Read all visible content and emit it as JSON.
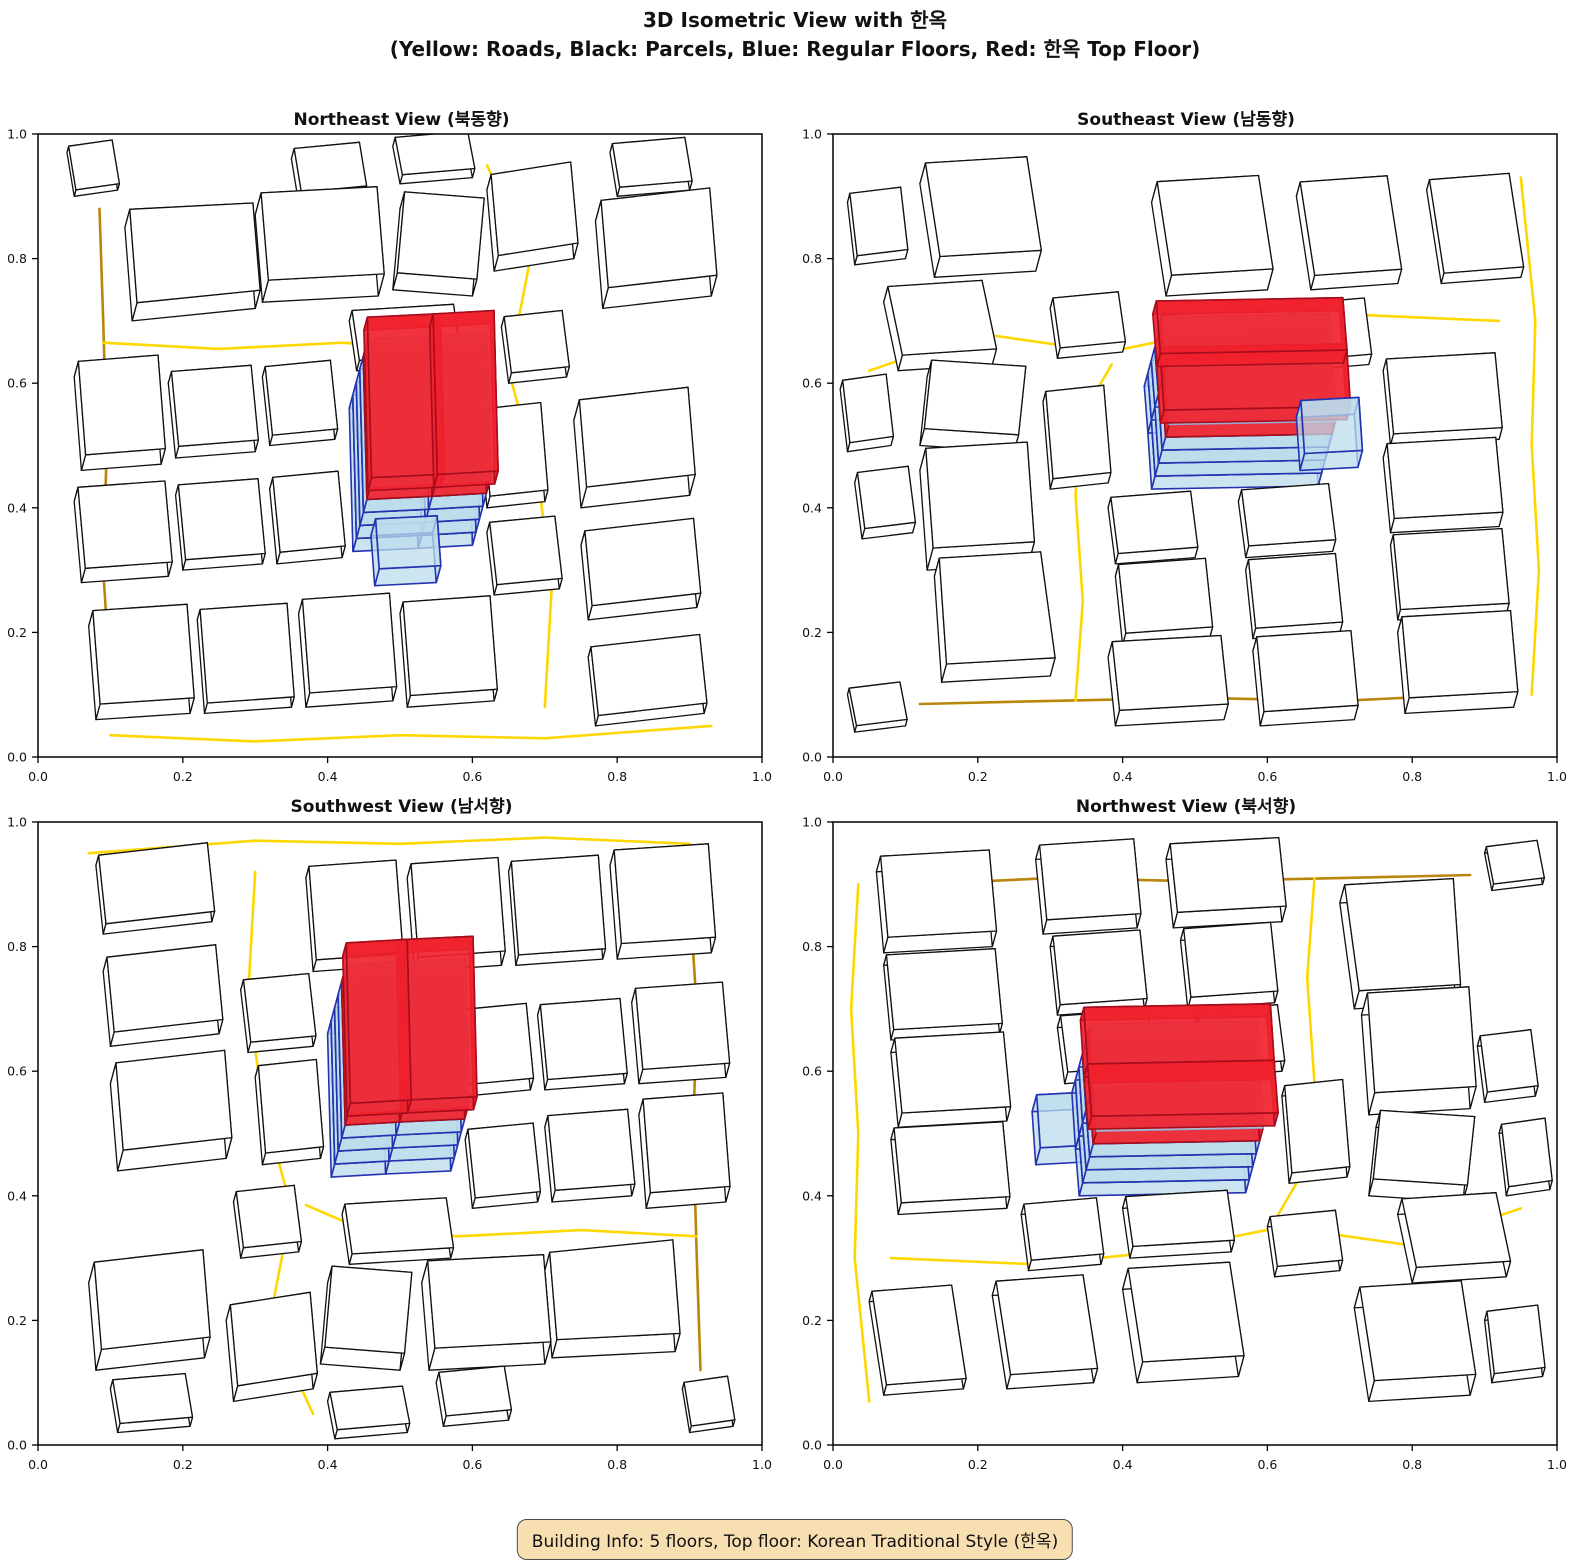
{
  "figure": {
    "title_line1": "3D Isometric View with 한옥",
    "title_line2": "(Yellow: Roads, Black: Parcels, Blue: Regular Floors, Red: 한옥 Top Floor)"
  },
  "panels": [
    {
      "title": "Northeast View (북동향)",
      "rotation_deg": 0
    },
    {
      "title": "Southeast View (남동향)",
      "rotation_deg": 90
    },
    {
      "title": "Southwest View (남서향)",
      "rotation_deg": 180
    },
    {
      "title": "Northwest View (북서향)",
      "rotation_deg": 270
    }
  ],
  "axes": {
    "ticks": [
      "0.0",
      "0.2",
      "0.4",
      "0.6",
      "0.8",
      "1.0"
    ],
    "range": [
      0,
      1
    ]
  },
  "legend": {
    "yellow": "Roads",
    "black": "Parcels",
    "blue": "Regular Floors",
    "red": "한옥 Top Floor"
  },
  "building_info": {
    "floors": 5,
    "top_floor_style": "Korean Traditional Style (한옥)"
  },
  "caption": {
    "text": "Building Info: 5 floors, Top floor: Korean Traditional Style (한옥)"
  },
  "colors": {
    "background": "#ffffff",
    "frame": "#000000",
    "road_gold": "#FFD700",
    "road_dark": "#B8860B",
    "parcel_fill": "#FFFFFF",
    "parcel_edge": "#111111",
    "floor_fill": "#BCDCEC",
    "floor_edge": "#2433B0",
    "floor_edge_light": "#8FA8D8",
    "hanok_fill": "#F0222E",
    "hanok_edge": "#A50D1C",
    "caption_bg": "#F7DFB2",
    "caption_border": "#4D4D4D"
  },
  "scene": {
    "projection": {
      "plot_w": 724,
      "plot_h": 623,
      "height_dx": 3.5,
      "height_dy": -13
    },
    "roads": [
      {
        "pts": [
          [
            0.085,
            0.88
          ],
          [
            0.09,
            0.7
          ],
          [
            0.095,
            0.5
          ],
          [
            0.09,
            0.3
          ],
          [
            0.1,
            0.12
          ]
        ],
        "tone": "dark"
      },
      {
        "pts": [
          [
            0.09,
            0.665
          ],
          [
            0.25,
            0.655
          ],
          [
            0.42,
            0.665
          ],
          [
            0.55,
            0.655
          ],
          [
            0.63,
            0.615
          ]
        ],
        "tone": "gold"
      },
      {
        "pts": [
          [
            0.62,
            0.95
          ],
          [
            0.68,
            0.8
          ],
          [
            0.65,
            0.62
          ],
          [
            0.69,
            0.45
          ],
          [
            0.71,
            0.28
          ],
          [
            0.7,
            0.08
          ]
        ],
        "tone": "gold"
      },
      {
        "pts": [
          [
            0.1,
            0.035
          ],
          [
            0.3,
            0.025
          ],
          [
            0.5,
            0.035
          ],
          [
            0.7,
            0.03
          ],
          [
            0.93,
            0.05
          ]
        ],
        "tone": "gold"
      }
    ],
    "buildings": [
      {
        "pts": [
          [
            0.13,
            0.7
          ],
          [
            0.3,
            0.72
          ],
          [
            0.29,
            0.86
          ],
          [
            0.12,
            0.85
          ]
        ],
        "h": 1.4
      },
      {
        "pts": [
          [
            0.31,
            0.73
          ],
          [
            0.47,
            0.74
          ],
          [
            0.46,
            0.88
          ],
          [
            0.3,
            0.87
          ]
        ],
        "h": 1.7
      },
      {
        "pts": [
          [
            0.36,
            0.89
          ],
          [
            0.45,
            0.9
          ],
          [
            0.44,
            0.97
          ],
          [
            0.35,
            0.96
          ]
        ],
        "h": 0.8
      },
      {
        "pts": [
          [
            0.49,
            0.75
          ],
          [
            0.6,
            0.74
          ],
          [
            0.61,
            0.87
          ],
          [
            0.5,
            0.88
          ]
        ],
        "h": 1.3
      },
      {
        "pts": [
          [
            0.63,
            0.78
          ],
          [
            0.74,
            0.8
          ],
          [
            0.73,
            0.93
          ],
          [
            0.62,
            0.91
          ]
        ],
        "h": 1.2
      },
      {
        "pts": [
          [
            0.78,
            0.72
          ],
          [
            0.93,
            0.74
          ],
          [
            0.92,
            0.88
          ],
          [
            0.77,
            0.86
          ]
        ],
        "h": 1.6
      },
      {
        "pts": [
          [
            0.8,
            0.9
          ],
          [
            0.9,
            0.91
          ],
          [
            0.89,
            0.98
          ],
          [
            0.79,
            0.97
          ]
        ],
        "h": 0.7
      },
      {
        "pts": [
          [
            0.06,
            0.46
          ],
          [
            0.17,
            0.47
          ],
          [
            0.16,
            0.62
          ],
          [
            0.05,
            0.61
          ]
        ],
        "h": 1.2
      },
      {
        "pts": [
          [
            0.19,
            0.48
          ],
          [
            0.3,
            0.49
          ],
          [
            0.29,
            0.61
          ],
          [
            0.18,
            0.6
          ]
        ],
        "h": 0.9
      },
      {
        "pts": [
          [
            0.32,
            0.5
          ],
          [
            0.41,
            0.51
          ],
          [
            0.4,
            0.62
          ],
          [
            0.31,
            0.61
          ]
        ],
        "h": 0.8
      },
      {
        "pts": [
          [
            0.06,
            0.28
          ],
          [
            0.18,
            0.29
          ],
          [
            0.17,
            0.42
          ],
          [
            0.05,
            0.41
          ]
        ],
        "h": 1.1
      },
      {
        "pts": [
          [
            0.2,
            0.3
          ],
          [
            0.31,
            0.31
          ],
          [
            0.3,
            0.43
          ],
          [
            0.19,
            0.42
          ]
        ],
        "h": 0.8
      },
      {
        "pts": [
          [
            0.33,
            0.31
          ],
          [
            0.42,
            0.32
          ],
          [
            0.41,
            0.44
          ],
          [
            0.32,
            0.43
          ]
        ],
        "h": 0.9
      },
      {
        "pts": [
          [
            0.08,
            0.06
          ],
          [
            0.21,
            0.07
          ],
          [
            0.2,
            0.22
          ],
          [
            0.07,
            0.21
          ]
        ],
        "h": 1.2
      },
      {
        "pts": [
          [
            0.23,
            0.07
          ],
          [
            0.35,
            0.08
          ],
          [
            0.34,
            0.23
          ],
          [
            0.22,
            0.22
          ]
        ],
        "h": 0.8
      },
      {
        "pts": [
          [
            0.37,
            0.08
          ],
          [
            0.49,
            0.09
          ],
          [
            0.48,
            0.24
          ],
          [
            0.36,
            0.23
          ]
        ],
        "h": 1.1
      },
      {
        "pts": [
          [
            0.51,
            0.08
          ],
          [
            0.63,
            0.09
          ],
          [
            0.62,
            0.24
          ],
          [
            0.5,
            0.23
          ]
        ],
        "h": 0.9
      },
      {
        "pts": [
          [
            0.75,
            0.4
          ],
          [
            0.9,
            0.42
          ],
          [
            0.89,
            0.56
          ],
          [
            0.74,
            0.54
          ]
        ],
        "h": 1.6
      },
      {
        "pts": [
          [
            0.76,
            0.22
          ],
          [
            0.91,
            0.24
          ],
          [
            0.9,
            0.36
          ],
          [
            0.75,
            0.34
          ]
        ],
        "h": 1.1
      },
      {
        "pts": [
          [
            0.77,
            0.05
          ],
          [
            0.92,
            0.07
          ],
          [
            0.91,
            0.18
          ],
          [
            0.76,
            0.16
          ]
        ],
        "h": 0.8
      },
      {
        "pts": [
          [
            0.62,
            0.4
          ],
          [
            0.7,
            0.41
          ],
          [
            0.69,
            0.55
          ],
          [
            0.61,
            0.54
          ]
        ],
        "h": 0.9
      },
      {
        "pts": [
          [
            0.63,
            0.26
          ],
          [
            0.72,
            0.27
          ],
          [
            0.71,
            0.37
          ],
          [
            0.62,
            0.36
          ]
        ],
        "h": 0.8
      },
      {
        "pts": [
          [
            0.44,
            0.62
          ],
          [
            0.58,
            0.63
          ],
          [
            0.57,
            0.71
          ],
          [
            0.43,
            0.7
          ]
        ],
        "h": 0.8
      },
      {
        "pts": [
          [
            0.5,
            0.92
          ],
          [
            0.6,
            0.93
          ],
          [
            0.59,
            0.99
          ],
          [
            0.49,
            0.98
          ]
        ],
        "h": 0.7
      },
      {
        "pts": [
          [
            0.65,
            0.6
          ],
          [
            0.73,
            0.61
          ],
          [
            0.72,
            0.7
          ],
          [
            0.64,
            0.69
          ]
        ],
        "h": 0.8
      },
      {
        "pts": [
          [
            0.05,
            0.9
          ],
          [
            0.11,
            0.91
          ],
          [
            0.1,
            0.98
          ],
          [
            0.04,
            0.97
          ]
        ],
        "h": 0.5
      }
    ],
    "main_building": {
      "masses": [
        [
          [
            0.435,
            0.33
          ],
          [
            0.525,
            0.335
          ],
          [
            0.52,
            0.565
          ],
          [
            0.43,
            0.56
          ]
        ],
        [
          [
            0.525,
            0.335
          ],
          [
            0.6,
            0.34
          ],
          [
            0.595,
            0.57
          ],
          [
            0.52,
            0.565
          ]
        ]
      ],
      "porch": [
        [
          0.465,
          0.275
        ],
        [
          0.55,
          0.28
        ],
        [
          0.545,
          0.36
        ],
        [
          0.46,
          0.355
        ]
      ],
      "regular_floors": 4,
      "red_floor_top": 5.0,
      "plate_z": [
        4.95,
        5.3
      ],
      "roof_z": [
        5.35,
        6.35
      ],
      "roof_scale": 1.12
    }
  }
}
